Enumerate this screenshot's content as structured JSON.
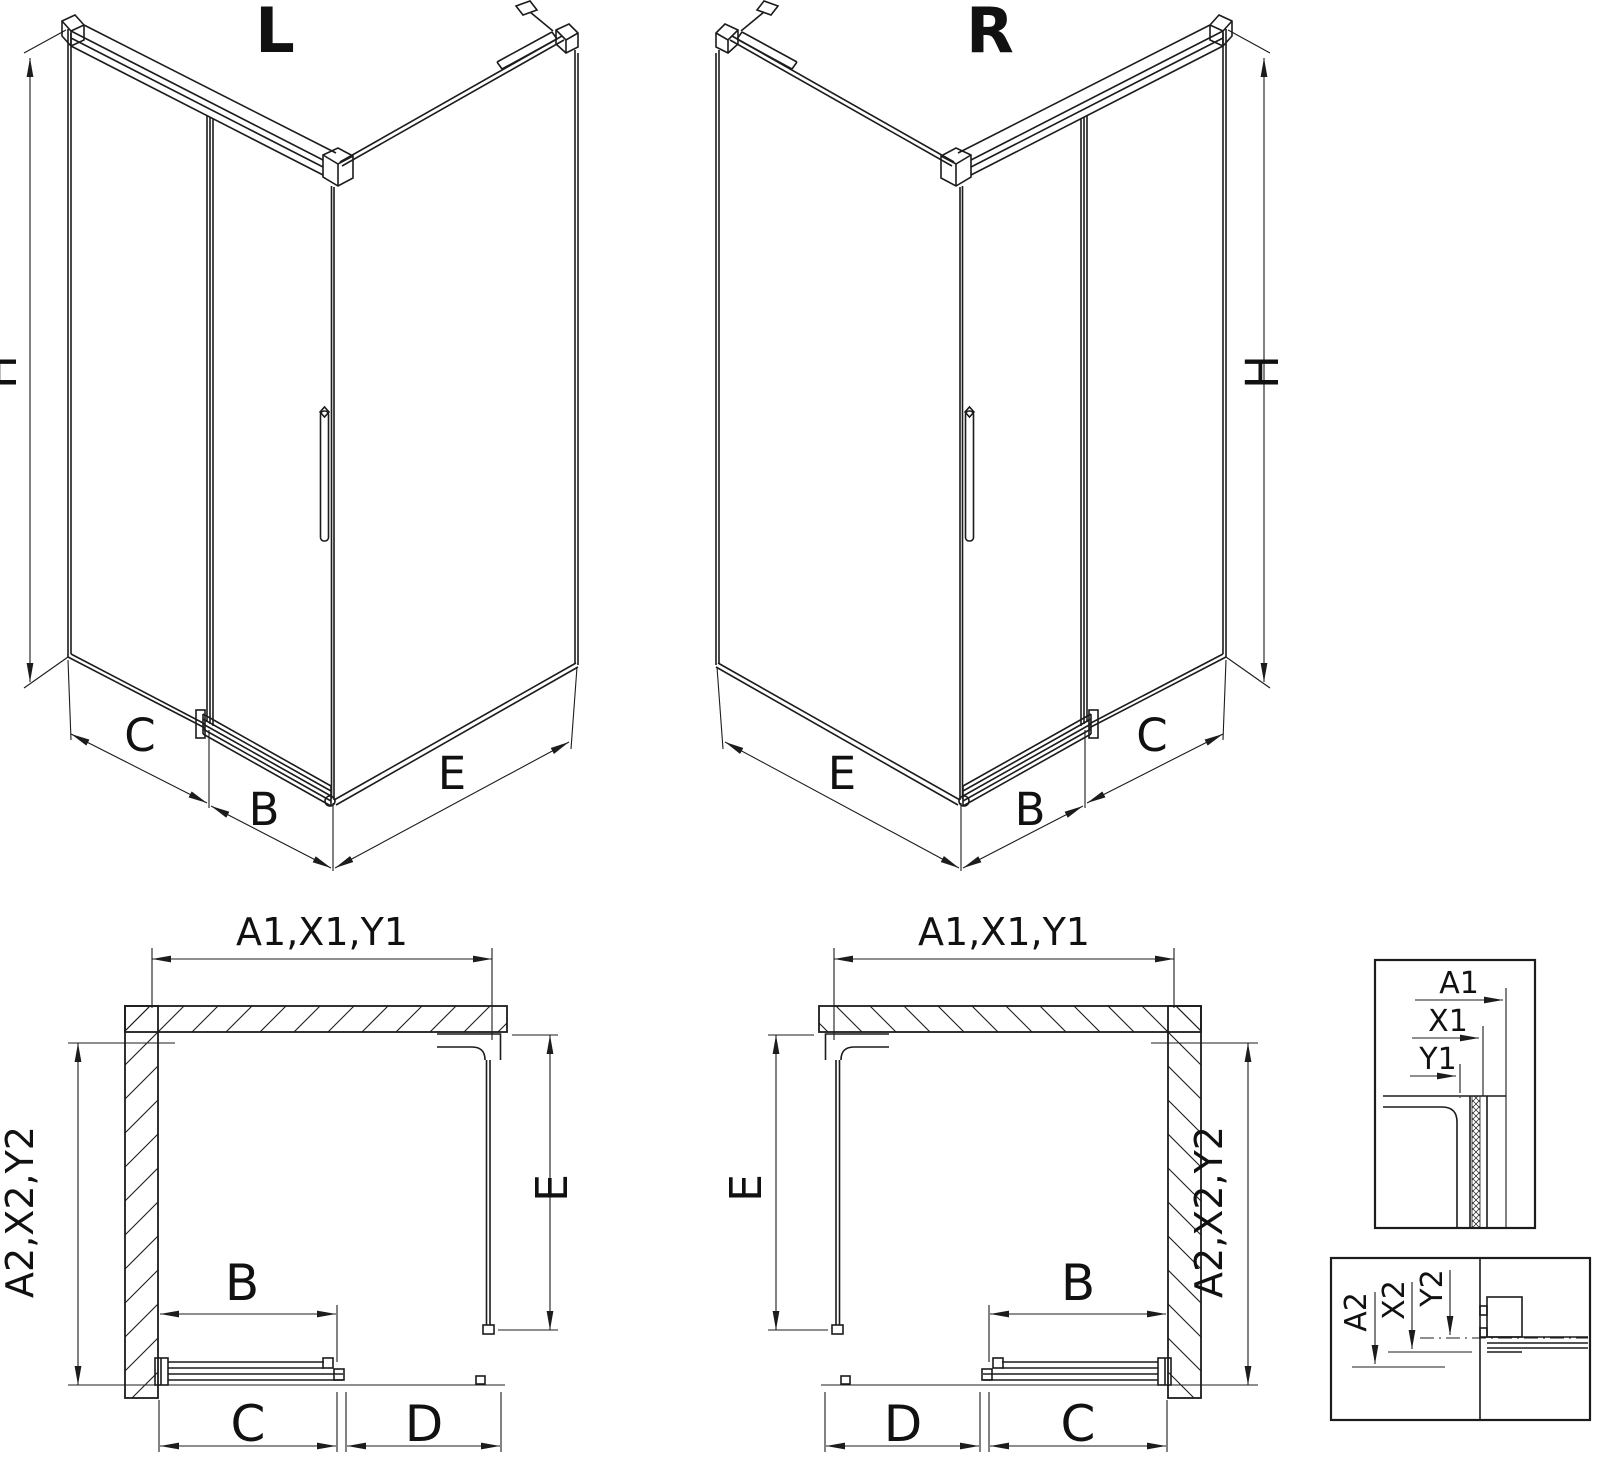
{
  "colors": {
    "line": "#1c1c1c",
    "background": "#ffffff"
  },
  "iso_left": {
    "title": "L",
    "height_label": "H",
    "bottom_labels": {
      "left": "C",
      "middle": "B",
      "right": "E"
    }
  },
  "iso_right": {
    "title": "R",
    "height_label": "H",
    "bottom_labels": {
      "left": "E",
      "middle": "B",
      "right": "C"
    }
  },
  "plan_left": {
    "top_label": "A1,X1,Y1",
    "left_label": "A2,X2,Y2",
    "right_label": "E",
    "door_label": "B",
    "bottom_left_label": "C",
    "bottom_right_label": "D"
  },
  "plan_right": {
    "top_label": "A1,X1,Y1",
    "left_label": "E",
    "right_label": "A2,X2,Y2",
    "door_label": "B",
    "bottom_left_label": "D",
    "bottom_right_label": "C"
  },
  "detail_top": {
    "labels": [
      "A1",
      "X1",
      "Y1"
    ]
  },
  "detail_bottom": {
    "labels": [
      "A2",
      "X2",
      "Y2"
    ]
  }
}
